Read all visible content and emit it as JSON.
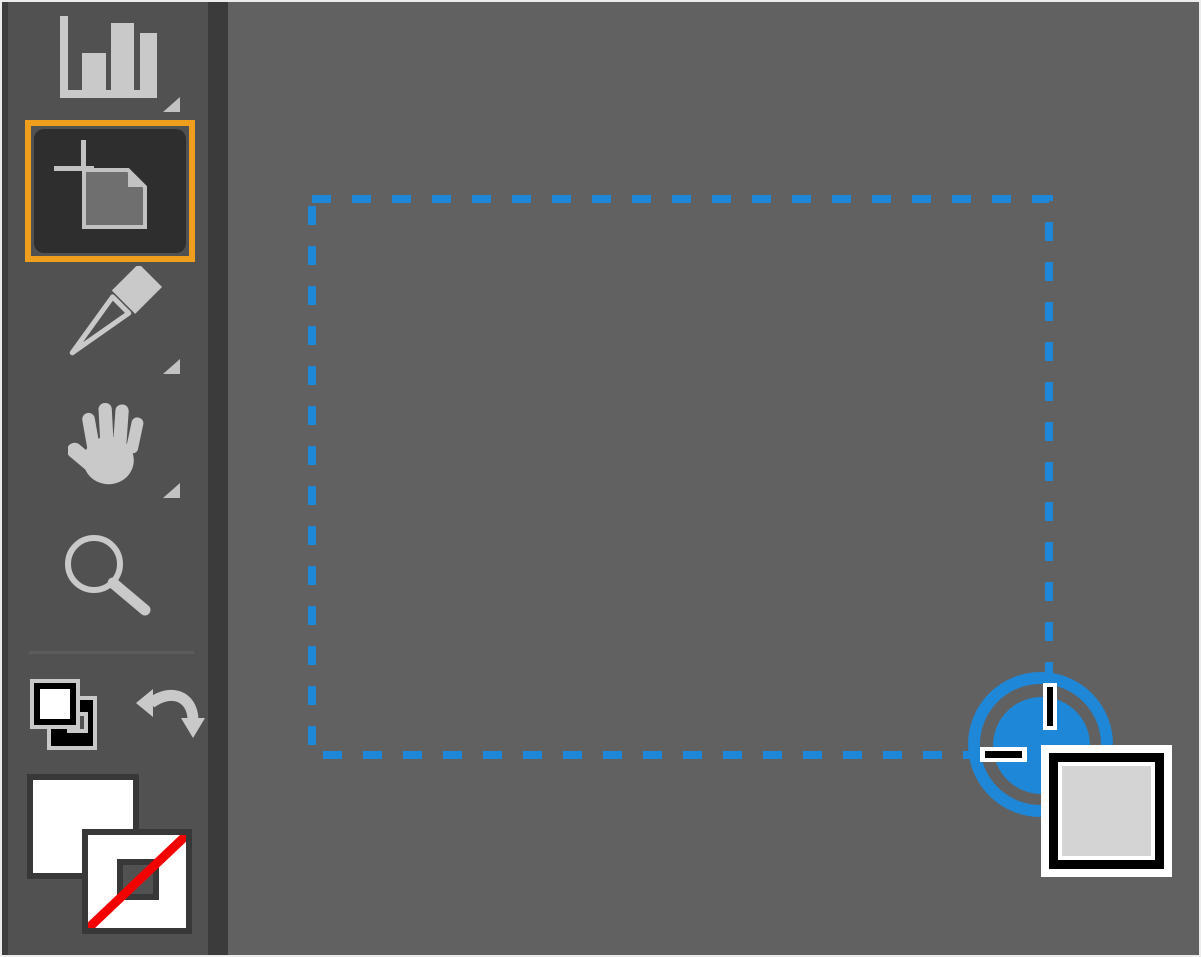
{
  "colors": {
    "canvas_bg": "#616161",
    "toolbar_bg": "#515151",
    "toolbar_edge": "#3B3B3B",
    "icon_gray": "#C9C9C9",
    "tool_highlight_orange": "#F09E1E",
    "selected_tool_well": "#2E2E2E",
    "selection_blue": "#1E87D7",
    "none_red": "#F40000",
    "fill_white": "#FFFFFF",
    "cursor_badge_fill": "#D4D4D4"
  },
  "toolbar": {
    "tools": [
      {
        "name": "column-graph-tool",
        "icon": "bar-chart-icon",
        "selected": false,
        "has_flyout": true
      },
      {
        "name": "artboard-tool",
        "icon": "artboard-icon",
        "selected": true,
        "has_flyout": false
      },
      {
        "name": "slice-tool",
        "icon": "knife-icon",
        "selected": false,
        "has_flyout": true
      },
      {
        "name": "hand-tool",
        "icon": "hand-icon",
        "selected": false,
        "has_flyout": true
      },
      {
        "name": "zoom-tool",
        "icon": "magnifier-icon",
        "selected": false,
        "has_flyout": false
      }
    ],
    "color_controls": {
      "default_fill_stroke": {
        "name": "default-fill-and-stroke",
        "icon": "default-swatches-icon"
      },
      "swap_fill_stroke": {
        "name": "swap-fill-and-stroke",
        "icon": "swap-arrows-icon"
      },
      "fill_swatch": {
        "name": "fill-swatch",
        "value": "#FFFFFF"
      },
      "stroke_swatch": {
        "name": "stroke-swatch",
        "value": "none"
      }
    }
  },
  "canvas": {
    "marquee": {
      "x": 310,
      "y": 197,
      "width": 737,
      "height": 556,
      "stroke": "#1E87D7",
      "stroke_width": 8,
      "dash": "19 21",
      "style": "dashed"
    },
    "cursor": {
      "kind": "artboard-tool-crosshair",
      "click_indicator": true,
      "x": 1048,
      "y": 755
    }
  }
}
